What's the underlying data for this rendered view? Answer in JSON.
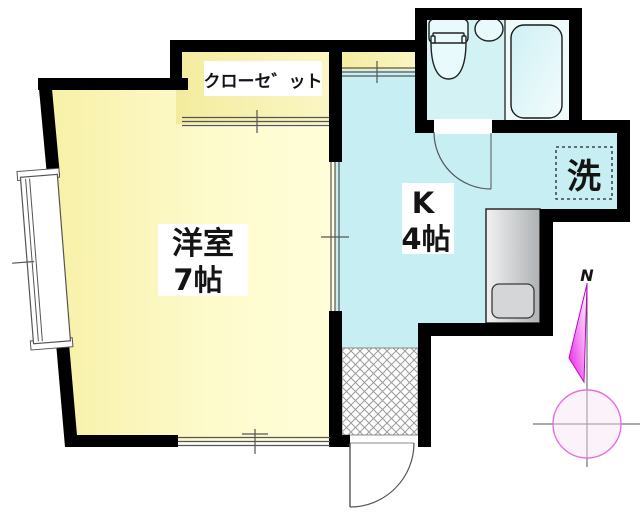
{
  "plan": {
    "main_room": {
      "name": "洋室",
      "size": "7帖"
    },
    "kitchen": {
      "name": "K",
      "size": "4帖"
    },
    "closet_label": "クローセ゛ット",
    "laundry_label": "洗",
    "compass_north": "N"
  },
  "colors": {
    "wall": "#000000",
    "room_yellow": "#F8F2A8",
    "room_yellow_light": "#FFFED8",
    "kitchen_cyan": "#C7EEF2",
    "bathroom_cyan": "#D3F2F4",
    "bath_section": "#EFFAFB",
    "fixture_fill": "#E8FAFB",
    "counter_gray": "#C9CBCD",
    "hatch_gray": "#999999",
    "line_gray": "#555555",
    "compass_magenta": "#E81CE8",
    "compass_circle_pink": "#E86FE0",
    "north_red": "#C41414"
  }
}
